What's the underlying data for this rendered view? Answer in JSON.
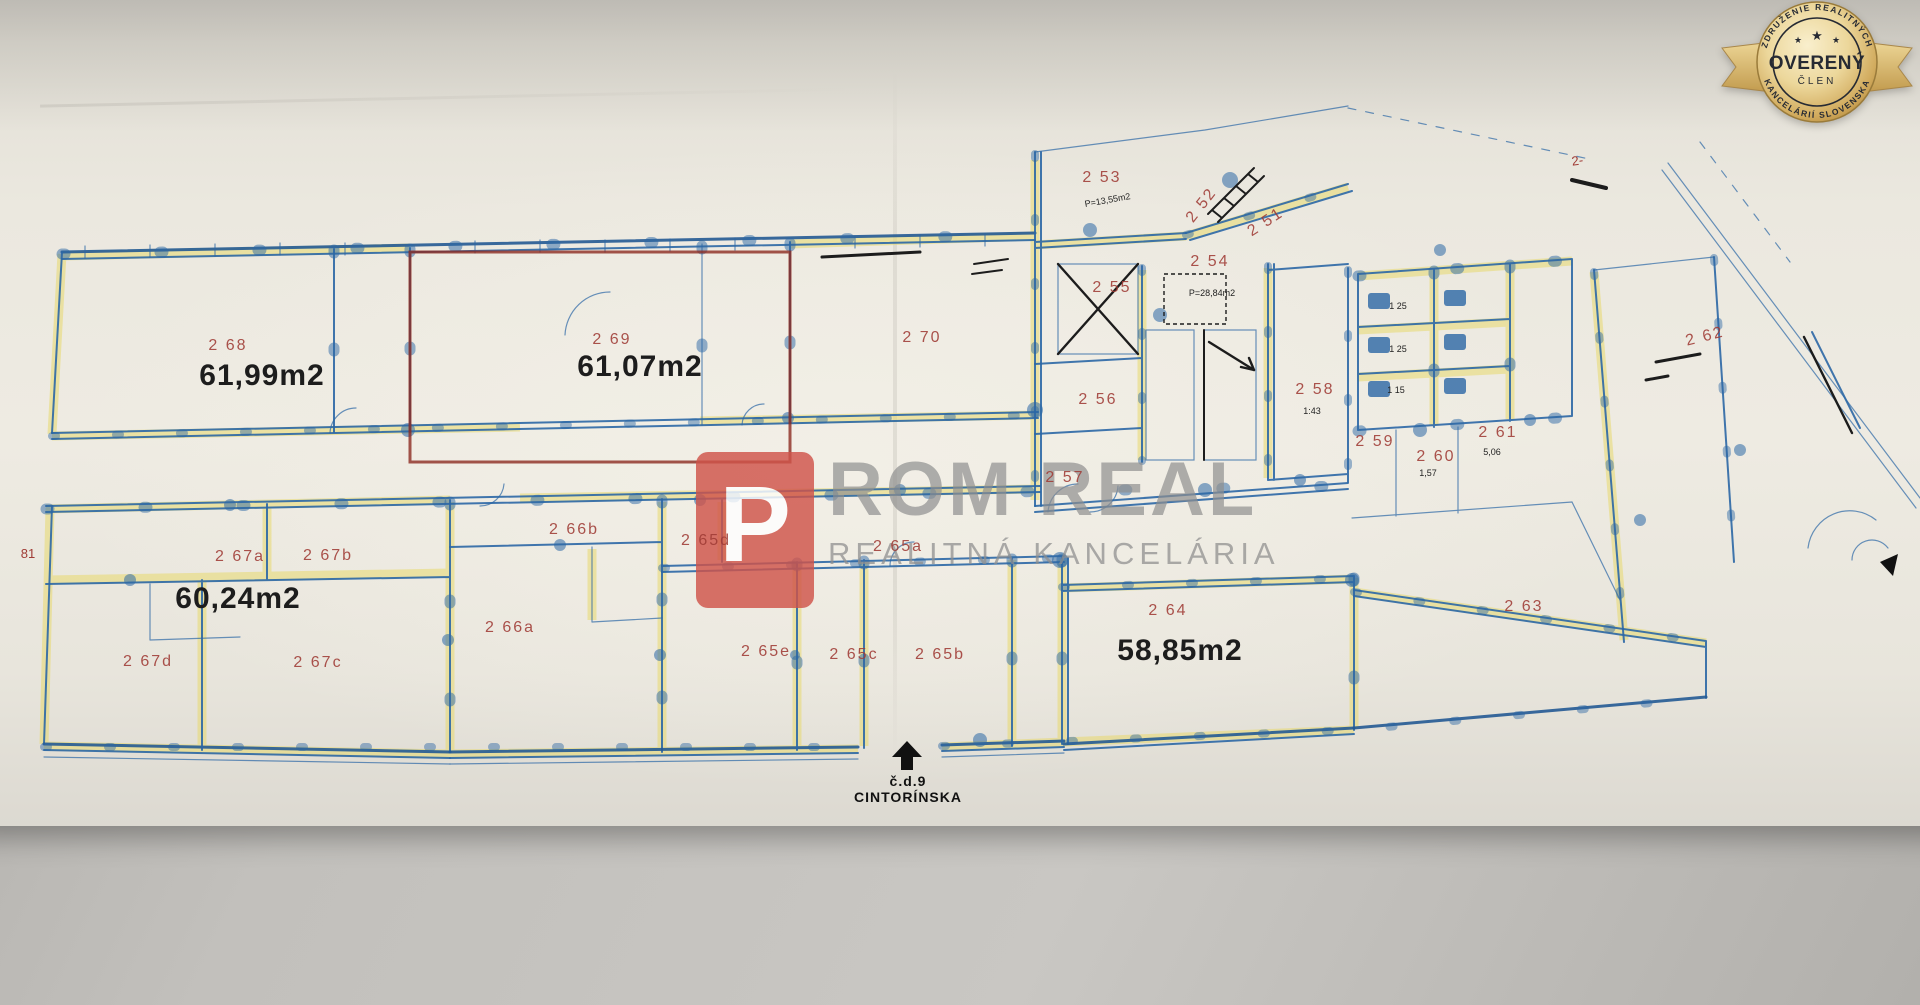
{
  "badge": {
    "association_top": "ZDRUŽENIE REALITNÝCH",
    "association_bottom": "KANCELÁRIÍ SLOVENSKA",
    "title": "OVERENÝ",
    "subtitle": "ČLEN",
    "star": "★",
    "gold_color": "#d4af5e",
    "text_color": "#262a33"
  },
  "watermark": {
    "brand_initial": "P",
    "brand_rest": "ROM REAL",
    "tagline": "REALITNÁ KANCELÁRIA",
    "logo_color": "#d0544a",
    "text_color": "#8f8f8f"
  },
  "entrance": {
    "house_number": "č.d.9",
    "street": "CINTORÍNSKA"
  },
  "plan": {
    "ink_color": "#2b67a5",
    "highlight_color": "#e7d96d",
    "label_color": "#a03c36",
    "unit_outline_color": "#8c2b20",
    "rooms": {
      "r268": {
        "label": "2 68",
        "area": "61,99m2"
      },
      "r269": {
        "label": "2 69",
        "area": "61,07m2"
      },
      "r270": {
        "label": "2 70"
      },
      "r251": {
        "label": "2 51"
      },
      "r252": {
        "label": "2 52"
      },
      "r253": {
        "label": "2 53",
        "note": "P=13,55m2"
      },
      "r254": {
        "label": "2 54",
        "note": "P=28,84m2"
      },
      "r255": {
        "label": "2 55"
      },
      "r256": {
        "label": "2 56"
      },
      "r257": {
        "label": "2 57"
      },
      "r258": {
        "label": "2 58",
        "note": "1:43"
      },
      "r259": {
        "label": "2 59"
      },
      "r260": {
        "label": "2 60",
        "note": "1,57"
      },
      "r261": {
        "label": "2 61",
        "note": "5,06"
      },
      "r262": {
        "label": "2 62"
      },
      "r263": {
        "label": "2 63"
      },
      "r264": {
        "label": "2 64",
        "area": "58,85m2"
      },
      "r265a": {
        "label": "2 65a"
      },
      "r265b": {
        "label": "2 65b"
      },
      "r265c": {
        "label": "2 65c"
      },
      "r265d": {
        "label": "2 65d"
      },
      "r265e": {
        "label": "2 65e"
      },
      "r266a": {
        "label": "2 66a"
      },
      "r266b": {
        "label": "2 66b"
      },
      "r267a": {
        "label": "2 67a"
      },
      "r267b": {
        "label": "2 67b"
      },
      "r267c": {
        "label": "2 67c"
      },
      "r267d": {
        "label": "2 67d"
      },
      "g267": {
        "area": "60,24m2"
      }
    },
    "marks": {
      "corner_left": "81",
      "top_right": "2-",
      "stall_dims": [
        "1 25",
        "1 25",
        "1 15"
      ]
    }
  }
}
